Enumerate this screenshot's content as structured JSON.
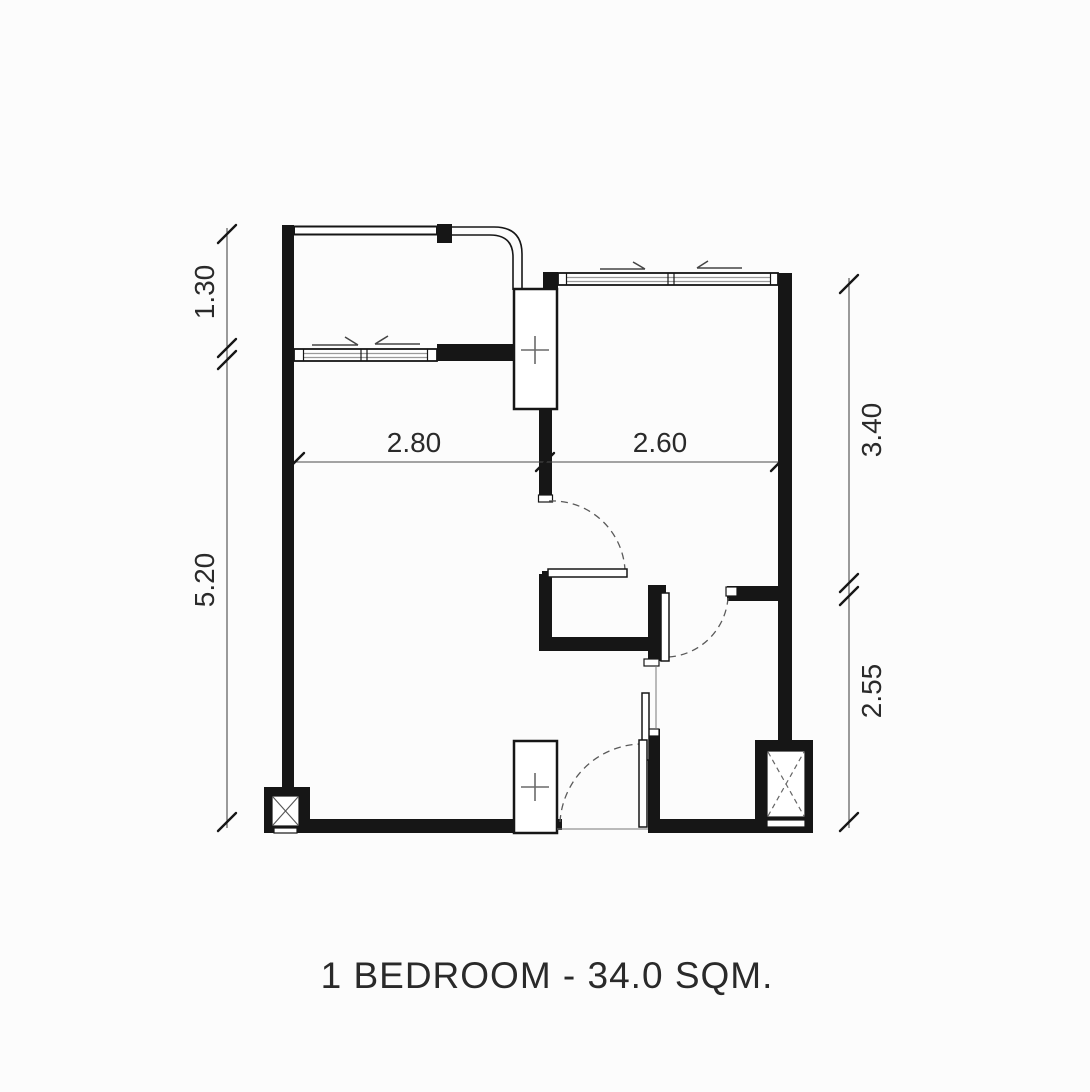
{
  "title": "1 BEDROOM - 34.0 SQM.",
  "dimensions": {
    "left_top": "1.30",
    "left_bottom": "5.20",
    "right_top": "3.40",
    "right_bottom": "2.55",
    "inner_left": "2.80",
    "inner_right": "2.60"
  },
  "symbols": {
    "shaft_marker": "plus",
    "column_marker": "x-cross",
    "door_swing_marker": "dashed-arc",
    "sliding_window_marker": "arrow"
  },
  "colors": {
    "background": "#fcfcfc",
    "wall": "#161616",
    "thin": "#4a4a4a",
    "dash": "#5a5a5a",
    "glass": "#9a9a9a",
    "text": "#2a2a2a"
  }
}
